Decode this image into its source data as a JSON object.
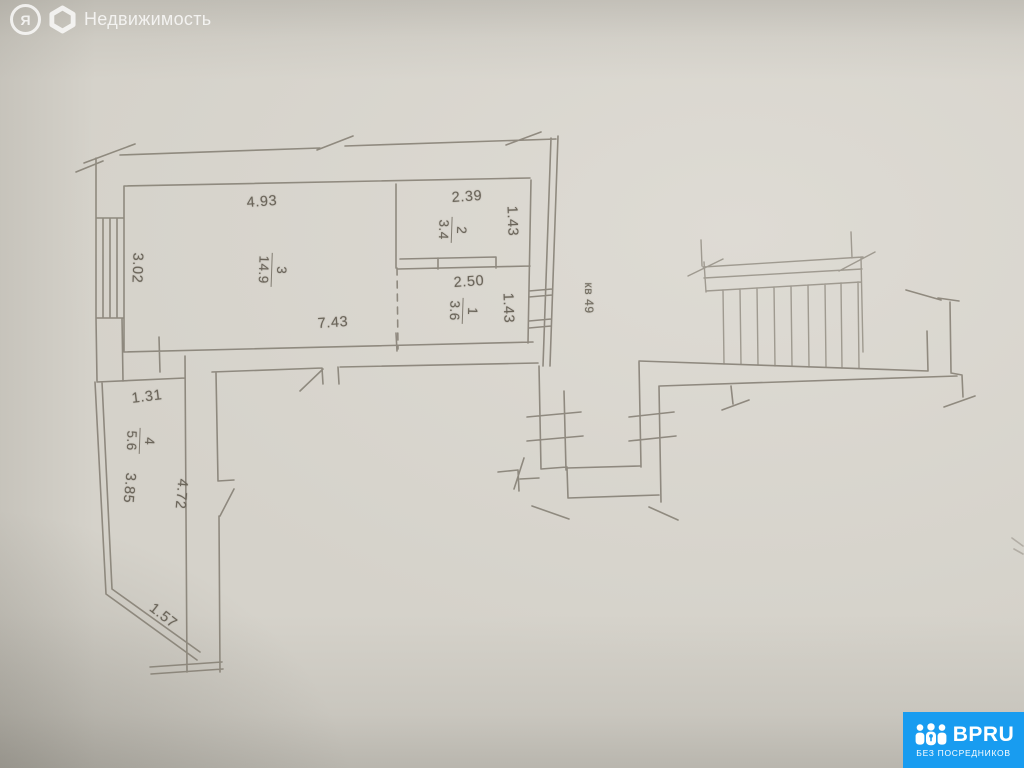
{
  "watermark": {
    "logo_letter": "Я",
    "label": "Недвижимость"
  },
  "badge": {
    "brand": "BPRU",
    "tagline": "БЕЗ ПОСРЕДНИКОВ",
    "color": "#189cf0"
  },
  "plan": {
    "unit_label": "кв 49",
    "rooms": [
      {
        "number": "1",
        "area": "3.6"
      },
      {
        "number": "2",
        "area": "3.4"
      },
      {
        "number": "3",
        "area": "14.9"
      },
      {
        "number": "4",
        "area": "5.6"
      }
    ],
    "dimensions": {
      "top_main": "4.93",
      "left_main": "3.02",
      "bottom_main": "7.43",
      "top_room2": "2.39",
      "right_room2": "1.43",
      "top_room1": "2.50",
      "right_room1": "1.43",
      "top_room4": "1.31",
      "left_room4": "3.85",
      "right_room4": "4.72",
      "diag_room4": "1.57"
    },
    "colors": {
      "paper": "#d5d2ca",
      "line": "#827c71",
      "text": "#6b655a"
    }
  }
}
